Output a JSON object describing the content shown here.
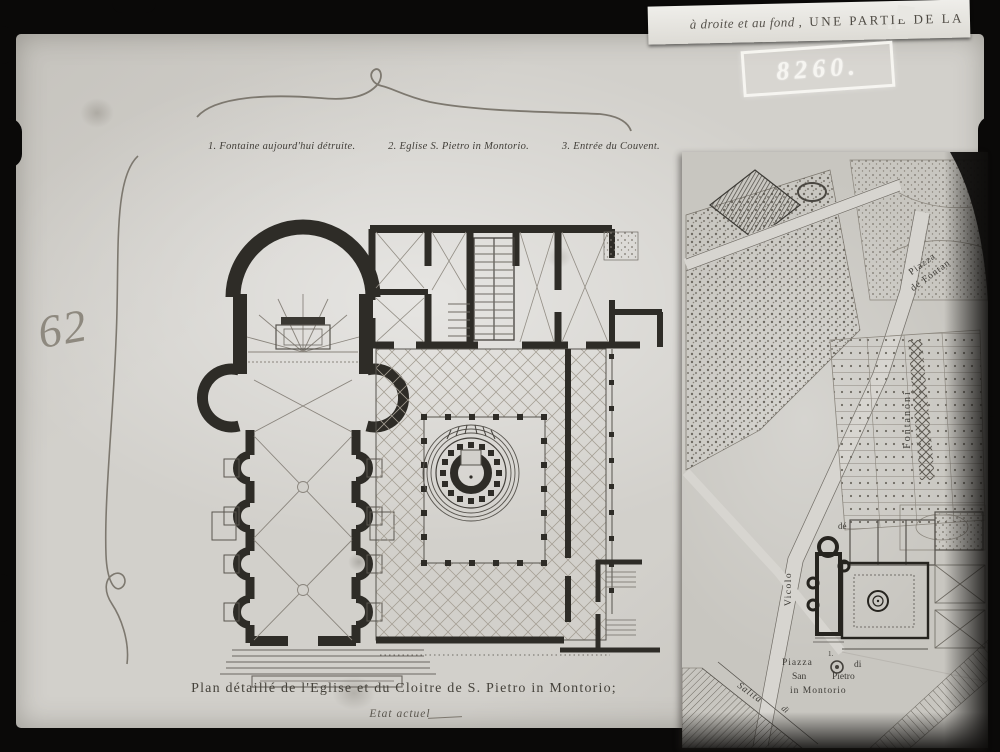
{
  "document": {
    "archive_number": "8260.",
    "plate_number": "62",
    "header_caption_script": "à droite et au fond ,",
    "header_caption_caps": "UNE PARTIE DE LA",
    "legend": {
      "items": [
        "1. Fontaine aujourd'hui détruite.",
        "2. Eglise S. Pietro in Montorio.",
        "3. Entrée du Couvent."
      ]
    },
    "caption": {
      "title": "Plan détaillé de l'Eglise et du Cloitre de S. Pietro in Montorio;",
      "subtitle": "Etat actuel"
    }
  },
  "map": {
    "labels": {
      "piazza_fontanoni_line1": "Piazza",
      "piazza_fontanoni_line2": "dé Fontan",
      "fontanoni": "Fontanoni",
      "vicolo": "Vicolo",
      "vicolo_de": "dé",
      "piazza": "Piazza",
      "di": "di",
      "san": "San",
      "pietro": "Pietro",
      "in_montorio": "in Montorio",
      "fountain_marker": "1.",
      "salita": "Salita",
      "salita_di": "di"
    }
  },
  "colors": {
    "frame_black": "#0a0908",
    "paper": "#d2d0cb",
    "map_paper": "#c8c6c0",
    "ink": "#2e2c27",
    "pencil": "#7d786f"
  }
}
